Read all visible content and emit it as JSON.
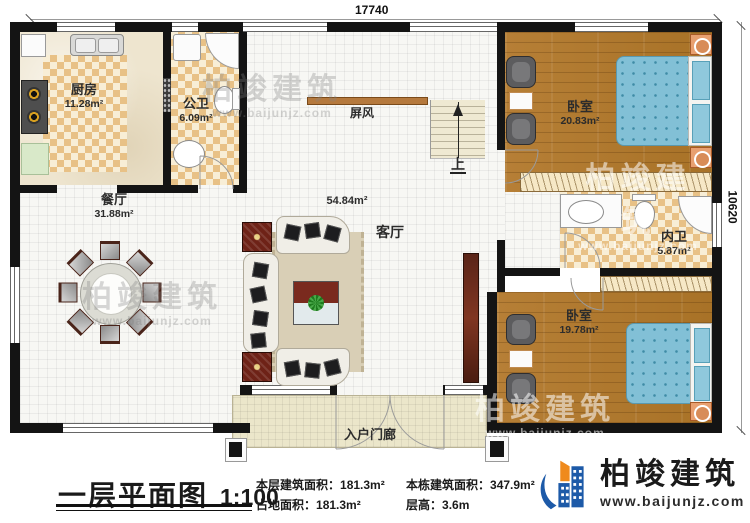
{
  "plan": {
    "dimensions": {
      "top": "17740",
      "right": "10620"
    },
    "rooms": {
      "kitchen": {
        "name": "厨房",
        "area": "11.28m²"
      },
      "public_bath": {
        "name": "公卫",
        "area": "6.09m²"
      },
      "dining": {
        "name": "餐厅",
        "area": "31.88m²"
      },
      "living": {
        "name": "客厅",
        "area": "54.84m²"
      },
      "bedroom_top": {
        "name": "卧室",
        "area": "20.83m²"
      },
      "inner_bath": {
        "name": "内卫",
        "area": "5.87m²"
      },
      "bedroom_bottom": {
        "name": "卧室",
        "area": "19.78m²"
      },
      "porch": {
        "name": "入户门廊"
      },
      "screen": {
        "name": "屏风"
      },
      "stairs": {
        "up_label": "上"
      }
    }
  },
  "watermark": {
    "name": "柏竣建筑",
    "url": "www.baijunjz.com"
  },
  "footer": {
    "title": "一层平面图",
    "scale": "1:100",
    "stats": [
      {
        "label": "本层建筑面积：",
        "value": "181.3m²"
      },
      {
        "label": "占地面积：",
        "value": "181.3m²"
      },
      {
        "label": "本栋建筑面积：",
        "value": "347.9m²"
      },
      {
        "label": "层高：",
        "value": "3.6m"
      }
    ],
    "logo": {
      "name": "柏竣建筑",
      "url": "www.baijunjz.com"
    }
  },
  "colors": {
    "wall": "#141414",
    "tile_orange": "#e8c186",
    "wood": "#b27c33",
    "bed_blue": "#82c0d6",
    "logo_blue": "#1d5aa8",
    "logo_orange": "#ef8a1d"
  }
}
